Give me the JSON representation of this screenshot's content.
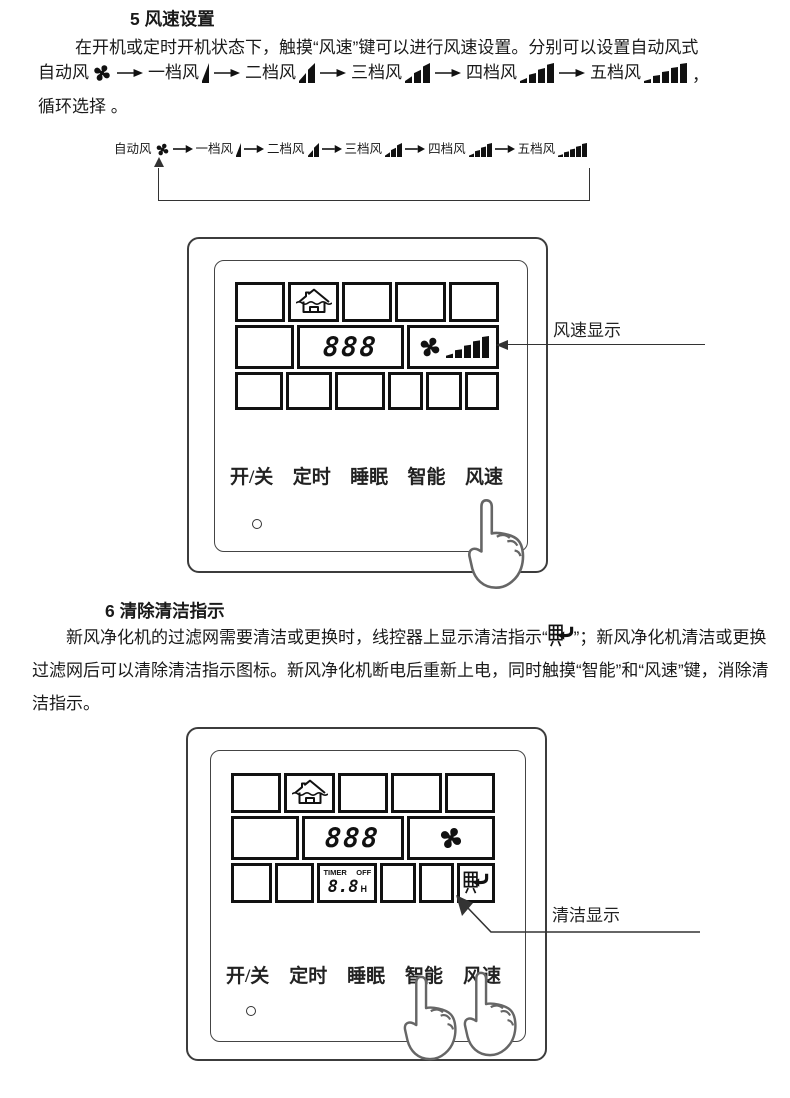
{
  "section5": {
    "heading": "5 风速设置",
    "line1": "在开机或定时开机状态下，触摸“风速”键可以进行风速设置。分别可以设置自动风式",
    "sequence_tail": "，",
    "line3": "循环选择 。"
  },
  "speed_sequence": [
    {
      "label": "自动风",
      "icon": "fan-icon",
      "bars": 0
    },
    {
      "label": "一档风",
      "icon": "speed-bars-1-icon",
      "bars": 1
    },
    {
      "label": "二档风",
      "icon": "speed-bars-2-icon",
      "bars": 2
    },
    {
      "label": "三档风",
      "icon": "speed-bars-3-icon",
      "bars": 3
    },
    {
      "label": "四档风",
      "icon": "speed-bars-4-icon",
      "bars": 4
    },
    {
      "label": "五档风",
      "icon": "speed-bars-5-icon",
      "bars": 5
    }
  ],
  "section6": {
    "heading": "6 清除清洁指示",
    "para_before_icon": "新风净化机的过滤网需要清洁或更换时，线控器上显示清洁指示“",
    "para_after_icon": "”；新风净化机清洁或更换过滤网后可以清除清洁指示图标。新风净化机断电后重新上电，同时触摸“智能”和“风速”键，消除清洁指示。"
  },
  "panel": {
    "buttons": [
      "开/关",
      "定时",
      "睡眠",
      "智能",
      "风速"
    ],
    "lcd": {
      "digits": "888",
      "timer_label": "TIMER",
      "timer_off": "OFF",
      "timer_value": "8.8",
      "timer_unit": "H"
    }
  },
  "annotations": {
    "fan_speed_display": "风速显示",
    "clean_display": "清洁显示"
  },
  "icons": {
    "fan": "fan-icon",
    "speed_bars": "speed-bars-icon",
    "house_vent": "house-ventilation-icon",
    "clean_filter": "clean-filter-icon",
    "pointing_hand": "pointing-hand-icon",
    "arrow": "arrow-right-icon"
  },
  "colors": {
    "ink": "#1a1a1a",
    "panel_line": "#3c3c3c",
    "lcd_border": "#111111"
  }
}
